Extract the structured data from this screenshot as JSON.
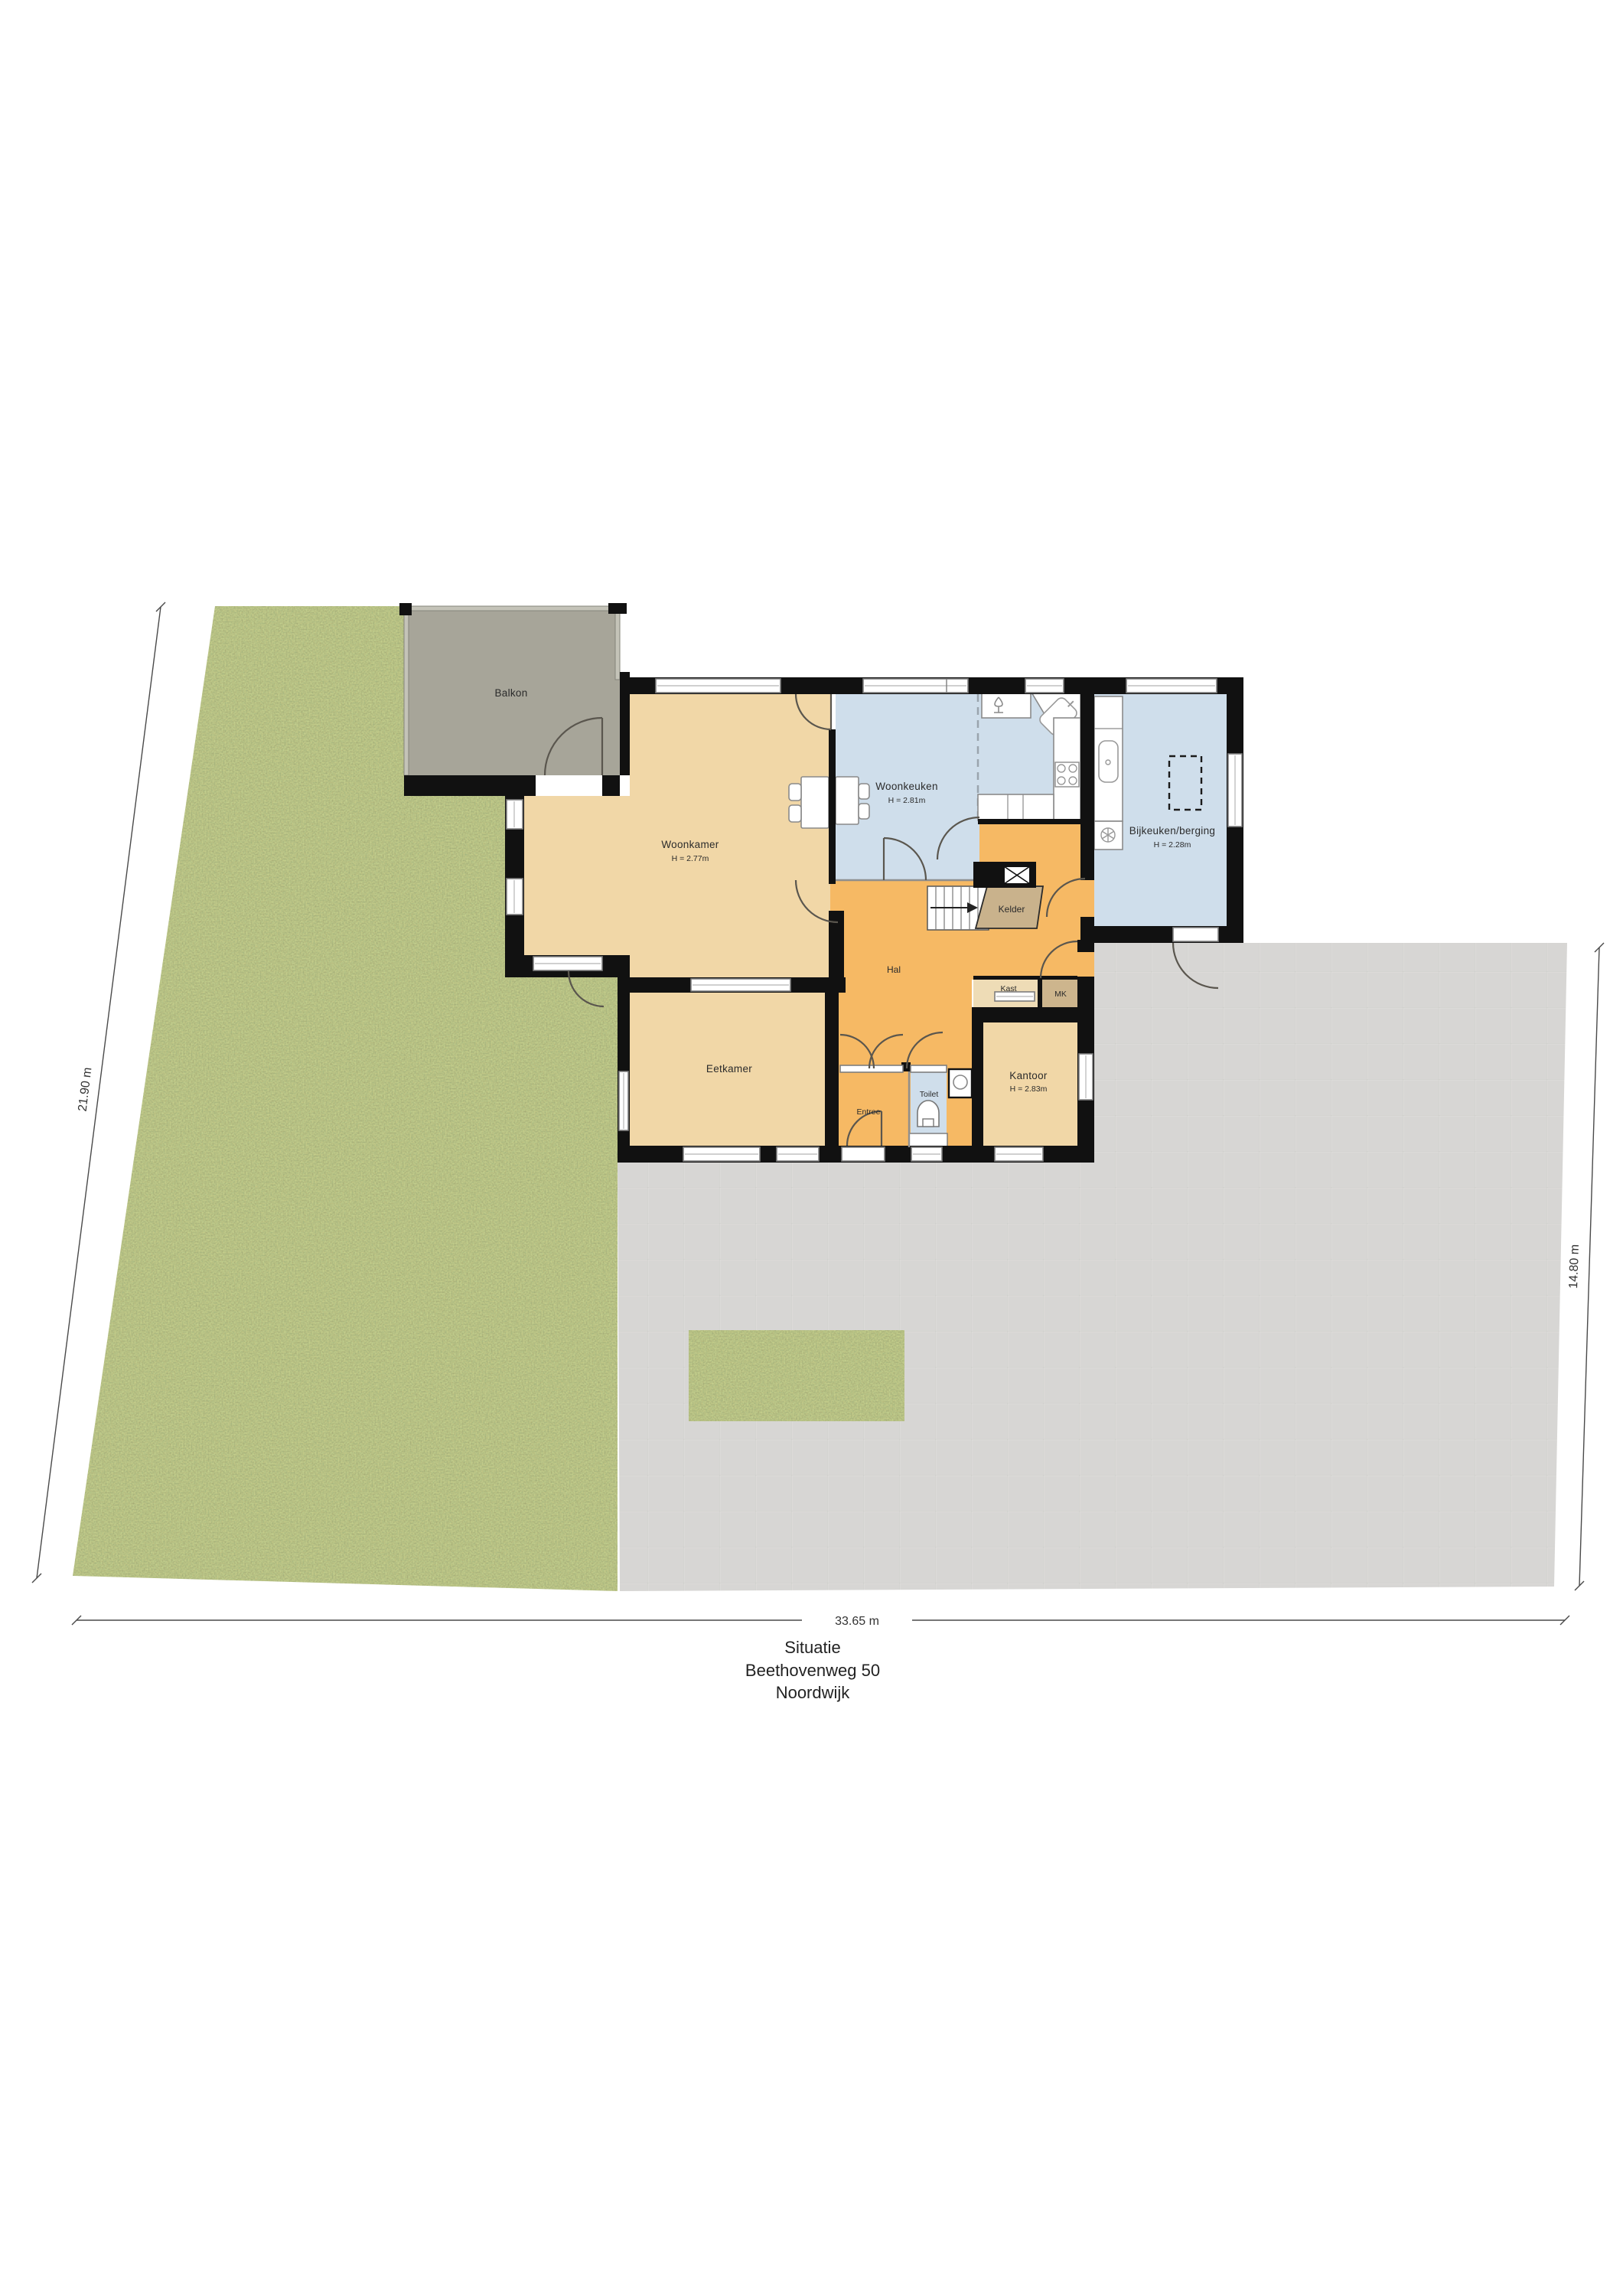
{
  "title": {
    "line1": "Situatie",
    "line2": "Beethovenweg 50",
    "line3": "Noordwijk"
  },
  "dimensions": {
    "bottom": "33.65 m",
    "left": "21.90 m",
    "right": "14.80 m"
  },
  "rooms": {
    "balkon": {
      "label": "Balkon"
    },
    "woonkamer": {
      "label": "Woonkamer",
      "height": "H = 2.77m"
    },
    "woonkeuken": {
      "label": "Woonkeuken",
      "height": "H = 2.81m"
    },
    "bijkeuken": {
      "label": "Bijkeuken/berging",
      "height": "H = 2.28m"
    },
    "kelder": {
      "label": "Kelder"
    },
    "hal": {
      "label": "Hal"
    },
    "kast": {
      "label": "Kast"
    },
    "mk": {
      "label": "MK"
    },
    "eetkamer": {
      "label": "Eetkamer"
    },
    "entree": {
      "label": "Entree"
    },
    "toilet": {
      "label": "Toilet"
    },
    "kantoor": {
      "label": "Kantoor",
      "height": "H = 2.83m"
    }
  },
  "colors": {
    "grass": "#7a8b3e",
    "paving": "#d7d6d4",
    "balcony": "#a7a599",
    "room_tan": "#f1d7a7",
    "room_orange": "#f6b964",
    "room_blue": "#cfdeeb",
    "kelder": "#c9b28c",
    "mk_fill": "#cdb58d",
    "wall": "#111111"
  }
}
